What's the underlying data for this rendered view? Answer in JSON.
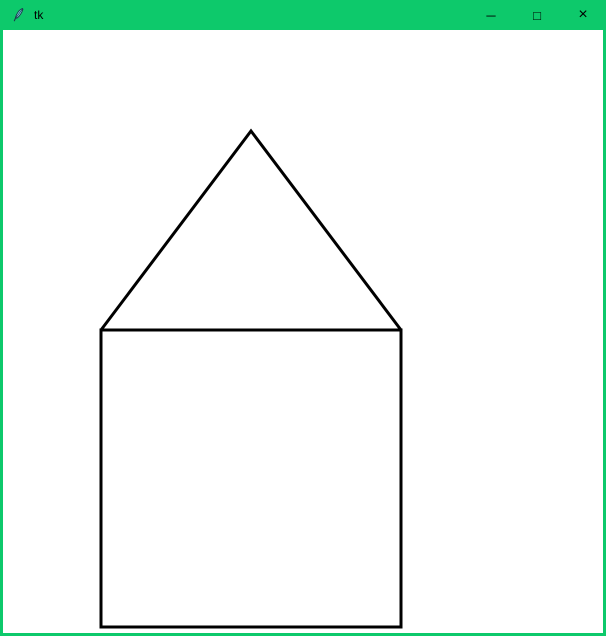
{
  "window": {
    "title": "tk",
    "accent_color": "#0DC96B",
    "canvas_color": "#FFFFFF"
  },
  "titlebar": {
    "icons": {
      "minimize": "─",
      "maximize": "□",
      "close": "×"
    }
  },
  "canvas": {
    "description": "white drawing canvas with a house shape (square body with triangular roof) drawn in black outline",
    "stroke": "#000000",
    "stroke_width": 3,
    "shapes": [
      {
        "name": "house-body-square",
        "type": "polygon",
        "points": [
          [
            98,
            300
          ],
          [
            398,
            300
          ],
          [
            398,
            597
          ],
          [
            98,
            597
          ]
        ]
      },
      {
        "name": "house-roof-triangle",
        "type": "polyline",
        "points": [
          [
            98,
            300
          ],
          [
            248,
            101
          ],
          [
            398,
            300
          ]
        ]
      }
    ]
  }
}
